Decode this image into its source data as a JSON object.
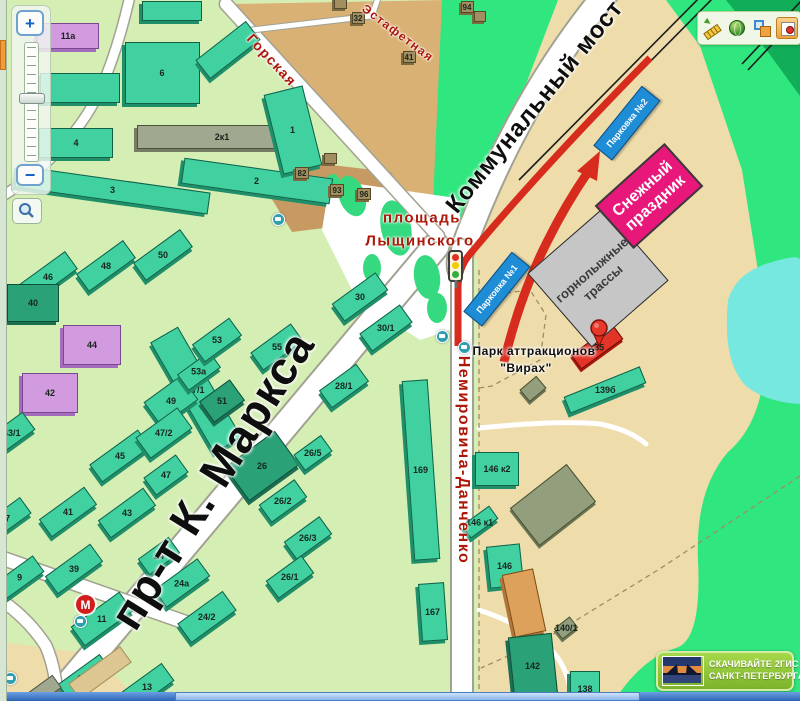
{
  "controls": {
    "zoom_in": "+",
    "zoom_out": "−"
  },
  "toolbar": {
    "icons": [
      "ruler-icon",
      "globe-icon",
      "layers-icon",
      "marker-tool-icon"
    ]
  },
  "badge": {
    "line1": "СКАЧИВАЙТЕ 2ГИС",
    "line2": "САНКТ-ПЕТЕРБУРГА"
  },
  "map": {
    "metro_label": "М",
    "annotations": {
      "snow_festival": {
        "line1": "Снежный",
        "line2": "праздник"
      },
      "ski_slopes": {
        "line1": "горнолыжные",
        "line2": "трассы"
      },
      "parkings": [
        {
          "label": "Парковка №1",
          "x": 497,
          "y": 289,
          "r": -51
        },
        {
          "label": "Парковка №2",
          "x": 627,
          "y": 123,
          "r": -51
        }
      ]
    },
    "street_labels": [
      {
        "text": "Горская",
        "x": 272,
        "y": 60,
        "r": 47,
        "s": 14,
        "cls": "red"
      },
      {
        "text": "Эстафетная",
        "x": 398,
        "y": 33,
        "r": 37,
        "s": 12,
        "cls": "red"
      },
      {
        "text": "Коммунальный мост",
        "x": 535,
        "y": 107,
        "r": -51,
        "s": 24,
        "cls": "black"
      },
      {
        "text": "пр-т К. Маркса",
        "x": 212,
        "y": 480,
        "r": -58,
        "s": 46,
        "cls": "black"
      },
      {
        "text": "Немировича-Данченко",
        "x": 463,
        "y": 460,
        "r": 90,
        "s": 16,
        "cls": "red"
      },
      {
        "text": "площадь",
        "x": 422,
        "y": 218,
        "r": 0,
        "s": 15,
        "cls": "red"
      },
      {
        "text": "Лыщинского",
        "x": 420,
        "y": 241,
        "r": 0,
        "s": 15,
        "cls": "red"
      },
      {
        "text": "Парк аттракционов",
        "x": 534,
        "y": 351,
        "r": 0,
        "s": 12,
        "cls": "black small"
      },
      {
        "text": "\"Вирах\"",
        "x": 526,
        "y": 368,
        "r": 0,
        "s": 12,
        "cls": "black small"
      }
    ],
    "buildings": [
      [
        68,
        36,
        62,
        26,
        0,
        "pu",
        "11а"
      ],
      [
        80,
        88,
        80,
        30,
        0,
        "g",
        ""
      ],
      [
        76,
        143,
        74,
        30,
        0,
        "g",
        "4"
      ],
      [
        112,
        190,
        195,
        22,
        8,
        "g",
        "3"
      ],
      [
        162,
        73,
        75,
        62,
        0,
        "g",
        "6"
      ],
      [
        228,
        50,
        64,
        24,
        -38,
        "g",
        ""
      ],
      [
        172,
        11,
        60,
        20,
        0,
        "g",
        ""
      ],
      [
        222,
        137,
        170,
        24,
        0,
        "gy",
        "2к1"
      ],
      [
        257,
        181,
        150,
        26,
        8,
        "g",
        "2"
      ],
      [
        293,
        130,
        40,
        82,
        -14,
        "g",
        "1"
      ],
      [
        48,
        277,
        58,
        22,
        -36,
        "g",
        "46"
      ],
      [
        106,
        266,
        58,
        22,
        -36,
        "g",
        "48"
      ],
      [
        163,
        255,
        58,
        22,
        -36,
        "g",
        "50"
      ],
      [
        33,
        303,
        52,
        38,
        0,
        "dg",
        "40"
      ],
      [
        92,
        345,
        58,
        40,
        0,
        "pu",
        "44"
      ],
      [
        50,
        393,
        56,
        40,
        0,
        "pu",
        "42"
      ],
      [
        196,
        390,
        32,
        128,
        -30,
        "g",
        "47/1"
      ],
      [
        120,
        456,
        60,
        22,
        -36,
        "g",
        "45"
      ],
      [
        171,
        401,
        46,
        30,
        -36,
        "g",
        "49"
      ],
      [
        164,
        433,
        52,
        26,
        -36,
        "g",
        "47/2"
      ],
      [
        166,
        475,
        40,
        22,
        -36,
        "g",
        "47"
      ],
      [
        199,
        371,
        40,
        20,
        -36,
        "g",
        "53а"
      ],
      [
        217,
        340,
        46,
        22,
        -36,
        "g",
        "53"
      ],
      [
        277,
        347,
        50,
        22,
        -36,
        "g",
        "55"
      ],
      [
        222,
        401,
        38,
        26,
        -36,
        "dg",
        "51"
      ],
      [
        68,
        512,
        56,
        22,
        -36,
        "g",
        "41"
      ],
      [
        127,
        513,
        56,
        22,
        -36,
        "g",
        "43"
      ],
      [
        12,
        433,
        42,
        22,
        -36,
        "g",
        "43/1"
      ],
      [
        8,
        518,
        44,
        20,
        -36,
        "g",
        "7"
      ],
      [
        20,
        577,
        46,
        20,
        -36,
        "g",
        "9"
      ],
      [
        74,
        569,
        56,
        22,
        -36,
        "g",
        "39"
      ],
      [
        102,
        619,
        60,
        24,
        -36,
        "g",
        "11"
      ],
      [
        182,
        583,
        54,
        22,
        -36,
        "g",
        "24а"
      ],
      [
        159,
        556,
        38,
        20,
        -36,
        "g",
        "24"
      ],
      [
        207,
        617,
        56,
        24,
        -36,
        "g",
        "24/2"
      ],
      [
        85,
        678,
        52,
        22,
        -36,
        "g",
        "13а"
      ],
      [
        147,
        687,
        52,
        22,
        -36,
        "g",
        "13"
      ],
      [
        262,
        466,
        62,
        42,
        -36,
        "dg",
        "26"
      ],
      [
        283,
        501,
        44,
        22,
        -36,
        "g",
        "26/2"
      ],
      [
        308,
        538,
        44,
        22,
        -36,
        "g",
        "26/3"
      ],
      [
        290,
        577,
        44,
        22,
        -36,
        "g",
        "26/1"
      ],
      [
        313,
        453,
        34,
        20,
        -36,
        "g",
        "26/5"
      ],
      [
        360,
        297,
        54,
        22,
        -36,
        "g",
        "30"
      ],
      [
        386,
        328,
        50,
        22,
        -36,
        "g",
        "30/1"
      ],
      [
        344,
        386,
        46,
        22,
        -36,
        "g",
        "28/1"
      ],
      [
        421,
        470,
        26,
        180,
        -4,
        "g",
        "169"
      ],
      [
        433,
        612,
        26,
        58,
        -4,
        "g",
        "167"
      ],
      [
        497,
        469,
        44,
        34,
        0,
        "g",
        "146 к2"
      ],
      [
        480,
        522,
        34,
        16,
        -36,
        "g",
        "146 к1"
      ],
      [
        505,
        566,
        34,
        42,
        -6,
        "g",
        "146"
      ],
      [
        524,
        603,
        32,
        64,
        -12,
        "or",
        ""
      ],
      [
        533,
        666,
        44,
        62,
        -6,
        "dg",
        "142"
      ],
      [
        585,
        689,
        30,
        36,
        0,
        "g",
        "138"
      ],
      [
        553,
        505,
        72,
        48,
        -38,
        "ol",
        ""
      ],
      [
        566,
        628,
        20,
        14,
        -38,
        "ol",
        "140/1"
      ],
      [
        605,
        390,
        82,
        18,
        -22,
        "g",
        "139б"
      ],
      [
        597,
        347,
        52,
        18,
        -36,
        "rd",
        "135"
      ],
      [
        533,
        389,
        22,
        16,
        -40,
        "ol",
        ""
      ],
      [
        340,
        3,
        13,
        12,
        0,
        "br",
        ""
      ],
      [
        358,
        18,
        13,
        12,
        0,
        "br",
        "32"
      ],
      [
        409,
        57,
        13,
        12,
        0,
        "br",
        "41"
      ],
      [
        467,
        7,
        13,
        12,
        0,
        "br",
        "94"
      ],
      [
        480,
        16,
        12,
        11,
        0,
        "br",
        ""
      ],
      [
        302,
        173,
        14,
        12,
        0,
        "br",
        "82"
      ],
      [
        330,
        158,
        13,
        11,
        0,
        "br",
        ""
      ],
      [
        337,
        190,
        14,
        12,
        0,
        "br",
        "93"
      ],
      [
        364,
        194,
        14,
        12,
        0,
        "br",
        "96"
      ],
      [
        45,
        690,
        30,
        16,
        -36,
        "gy",
        ""
      ],
      [
        100,
        673,
        64,
        20,
        -36,
        "tn",
        ""
      ]
    ],
    "trees": [
      [
        352,
        196,
        26,
        42,
        -20
      ],
      [
        396,
        228,
        30,
        56,
        -12
      ],
      [
        427,
        277,
        26,
        44,
        -8
      ],
      [
        372,
        268,
        18,
        28,
        0
      ],
      [
        437,
        308,
        20,
        30,
        0
      ],
      [
        333,
        186,
        16,
        24,
        0
      ]
    ],
    "bus_stops": [
      [
        278,
        219
      ],
      [
        442,
        336
      ],
      [
        464,
        347
      ],
      [
        80,
        621
      ],
      [
        10,
        678
      ]
    ]
  }
}
